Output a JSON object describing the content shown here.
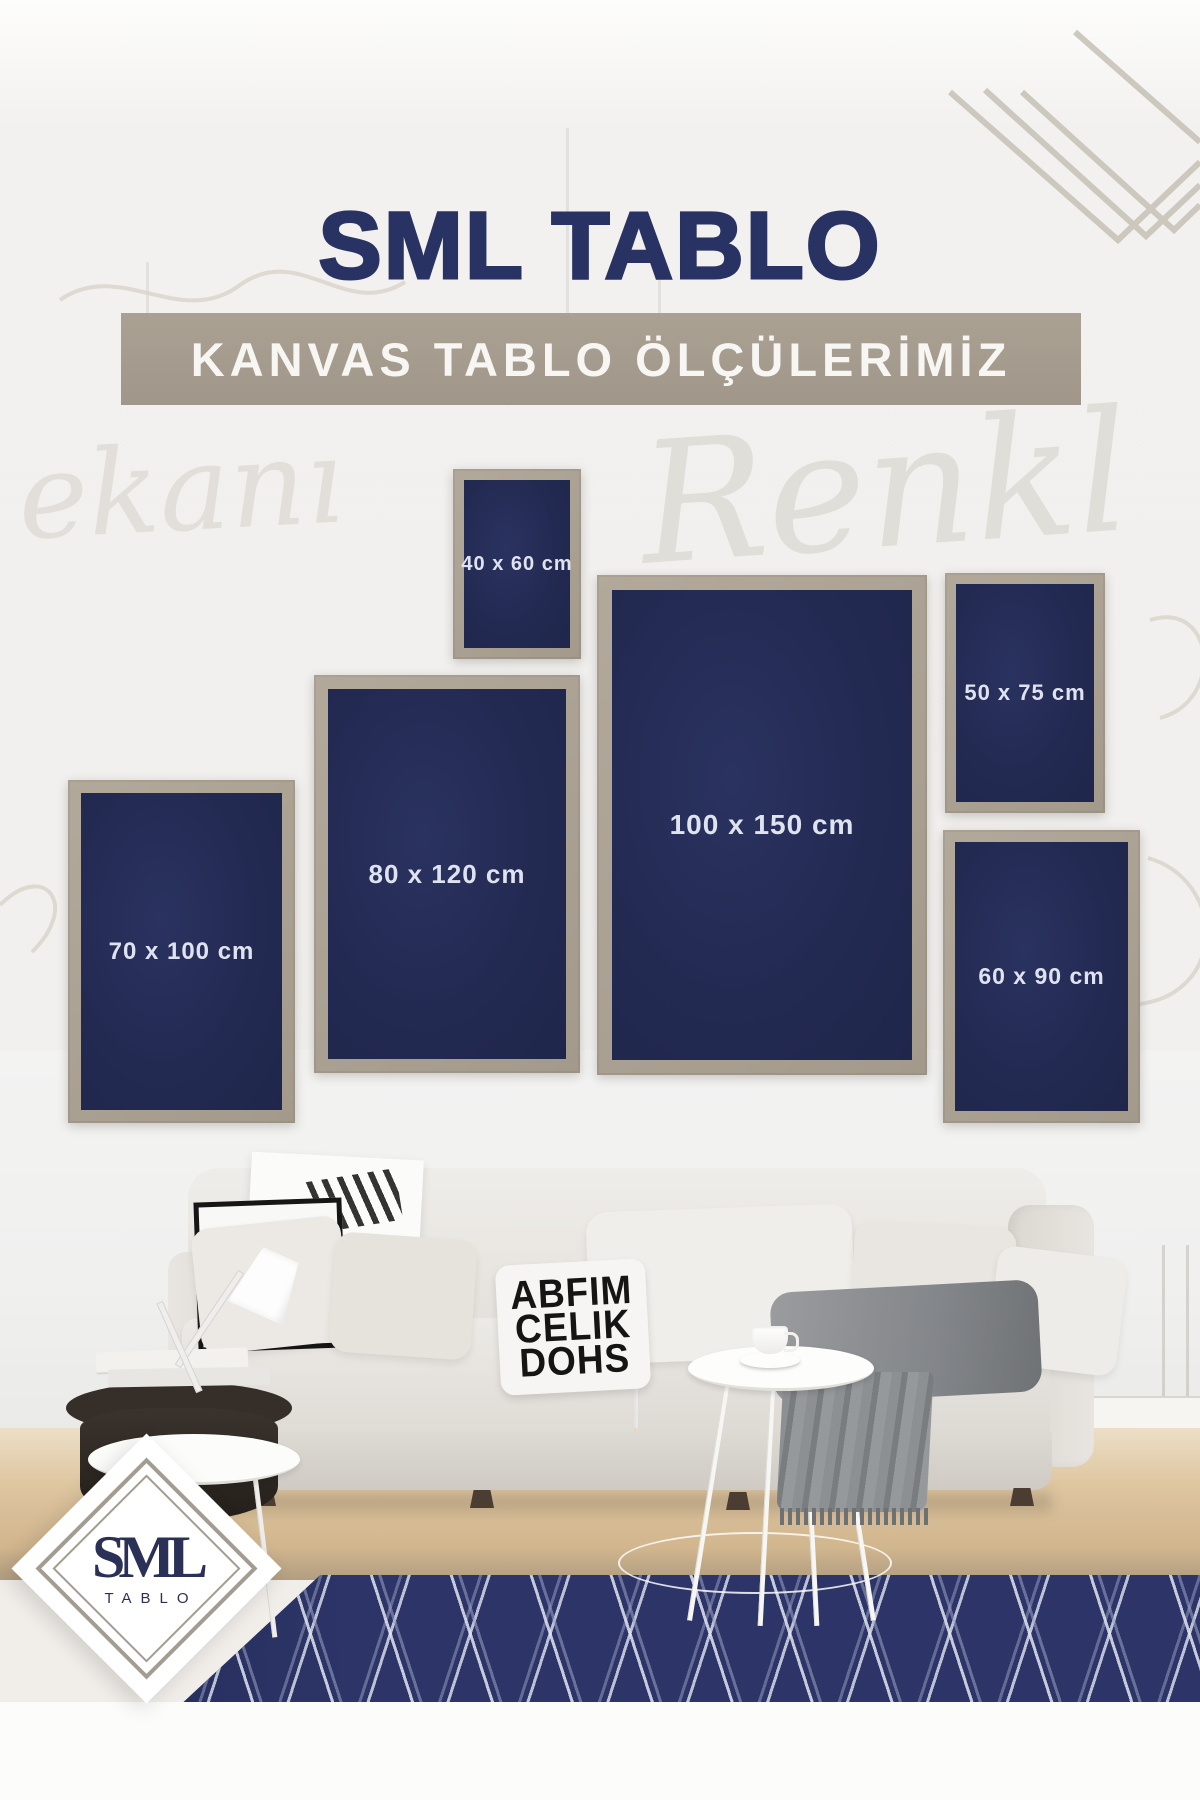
{
  "poster": {
    "title": "SML TABLO",
    "banner": "KANVAS TABLO ÖLÇÜLERİMİZ",
    "background_words": [
      "Renkl",
      "ekanı"
    ],
    "colors": {
      "canvas_navy": "#232a52",
      "frame_beige": "#a89f92",
      "banner_taupe": "#a49b8d",
      "title_navy": "#283263",
      "label_text": "#dfe3f0",
      "rug_navy": "#2d3568"
    }
  },
  "frames": [
    {
      "id": "40x60",
      "label": "40 x 60 cm"
    },
    {
      "id": "80x120",
      "label": "80 x 120 cm"
    },
    {
      "id": "100x150",
      "label": "100 x 150 cm"
    },
    {
      "id": "50x75",
      "label": "50 x 75 cm"
    },
    {
      "id": "60x90",
      "label": "60 x 90 cm"
    },
    {
      "id": "70x100",
      "label": "70 x 100 cm"
    }
  ],
  "photo": {
    "pillow_text_rows": [
      "ABFIM",
      "CELIK",
      "DOHS"
    ],
    "poster_text": "ESTA"
  },
  "logo": {
    "initials": "SML",
    "word": "TABLO"
  }
}
